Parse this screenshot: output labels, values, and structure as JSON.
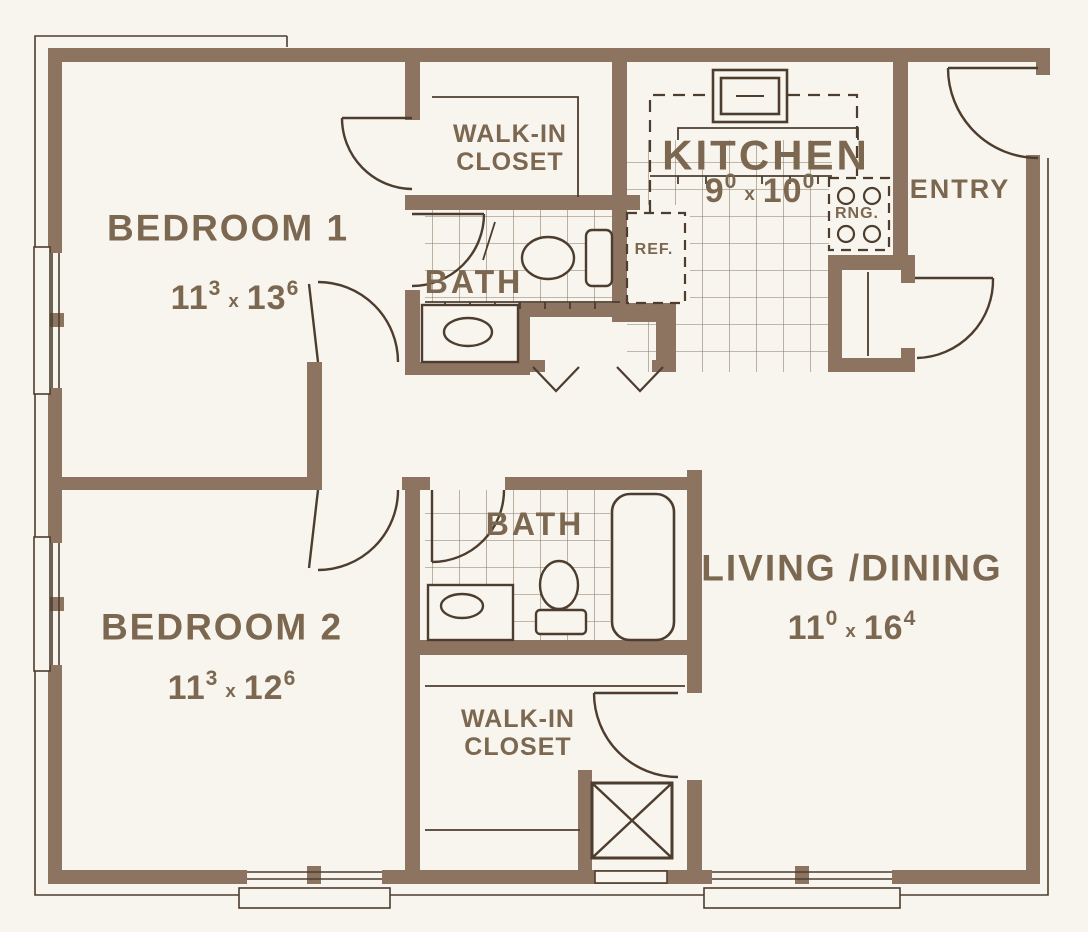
{
  "plan": {
    "rooms": [
      {
        "name": "BEDROOM 1",
        "dim": {
          "a": "11",
          "as": "3",
          "sep": "x",
          "b": "13",
          "bs": "6"
        }
      },
      {
        "name": "BEDROOM 2",
        "dim": {
          "a": "11",
          "as": "3",
          "sep": "x",
          "b": "12",
          "bs": "6"
        }
      },
      {
        "name": "LIVING /DINING",
        "dim": {
          "a": "11",
          "as": "0",
          "sep": "x",
          "b": "16",
          "bs": "4"
        }
      },
      {
        "name": "KITCHEN",
        "dim": {
          "a": "9",
          "as": "0",
          "sep": "x",
          "b": "10",
          "bs": "0"
        }
      }
    ],
    "labels": {
      "walk_in": {
        "line1": "WALK-IN",
        "line2": "CLOSET"
      },
      "bath": "BATH",
      "entry": "ENTRY",
      "ref": "REF.",
      "rng": "RNG."
    },
    "colors": {
      "background": "#f8f5ee",
      "wall": "#8d7460",
      "line": "#4c3d2f",
      "text": "#7c6750"
    }
  }
}
